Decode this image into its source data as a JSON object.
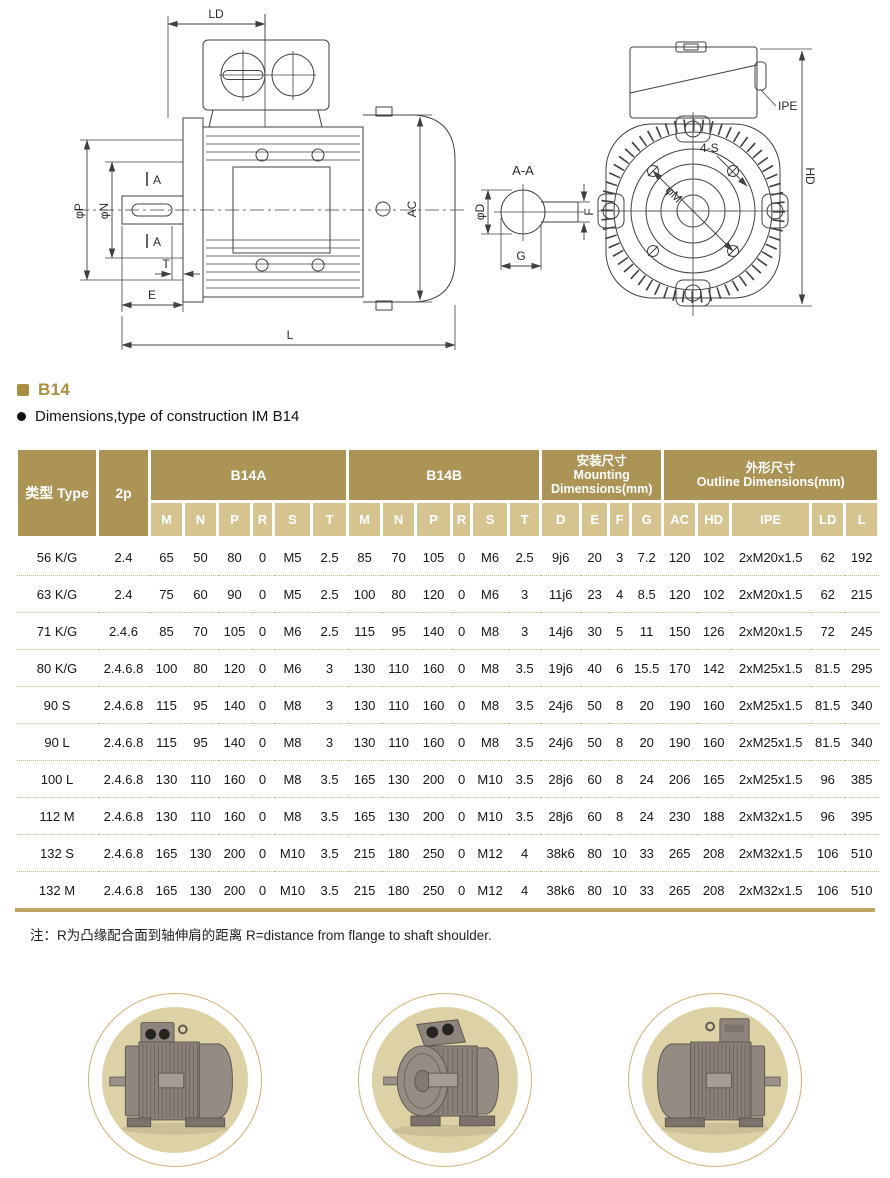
{
  "section": {
    "tag": "B14",
    "description": "Dimensions,type of construction IM B14"
  },
  "drawing_labels": {
    "side": {
      "ld": "LD",
      "phi_p": "φP",
      "phi_n": "φN",
      "a_upper": "A",
      "a_lower": "A",
      "t": "T",
      "e": "E",
      "l": "L",
      "ac": "AC"
    },
    "section_view": {
      "title": "A-A",
      "phi_d": "φD",
      "f": "F",
      "g": "G"
    },
    "front": {
      "ipe": "IPE",
      "four_s": "4-S",
      "phi_m": "φM",
      "hd": "HD"
    }
  },
  "table": {
    "header": {
      "type": "类型 Type",
      "p2": "2p",
      "b14a": "B14A",
      "b14b": "B14B",
      "mounting_zh": "安装尺寸",
      "mounting_en1": "Mounting",
      "mounting_en2": "Dimensions(mm)",
      "outline_zh": "外形尺寸",
      "outline_en": "Outline Dimensions(mm)"
    },
    "subheader": [
      "M",
      "N",
      "P",
      "R",
      "S",
      "T",
      "M",
      "N",
      "P",
      "R",
      "S",
      "T",
      "D",
      "E",
      "F",
      "G",
      "AC",
      "HD",
      "IPE",
      "LD",
      "L"
    ],
    "rows": [
      [
        "56 K/G",
        "2.4",
        "65",
        "50",
        "80",
        "0",
        "M5",
        "2.5",
        "85",
        "70",
        "105",
        "0",
        "M6",
        "2.5",
        "9j6",
        "20",
        "3",
        "7.2",
        "120",
        "102",
        "2xM20x1.5",
        "62",
        "192"
      ],
      [
        "63 K/G",
        "2.4",
        "75",
        "60",
        "90",
        "0",
        "M5",
        "2.5",
        "100",
        "80",
        "120",
        "0",
        "M6",
        "3",
        "11j6",
        "23",
        "4",
        "8.5",
        "120",
        "102",
        "2xM20x1.5",
        "62",
        "215"
      ],
      [
        "71 K/G",
        "2.4.6",
        "85",
        "70",
        "105",
        "0",
        "M6",
        "2.5",
        "115",
        "95",
        "140",
        "0",
        "M8",
        "3",
        "14j6",
        "30",
        "5",
        "11",
        "150",
        "126",
        "2xM20x1.5",
        "72",
        "245"
      ],
      [
        "80 K/G",
        "2.4.6.8",
        "100",
        "80",
        "120",
        "0",
        "M6",
        "3",
        "130",
        "110",
        "160",
        "0",
        "M8",
        "3.5",
        "19j6",
        "40",
        "6",
        "15.5",
        "170",
        "142",
        "2xM25x1.5",
        "81.5",
        "295"
      ],
      [
        "90 S",
        "2.4.6.8",
        "115",
        "95",
        "140",
        "0",
        "M8",
        "3",
        "130",
        "110",
        "160",
        "0",
        "M8",
        "3.5",
        "24j6",
        "50",
        "8",
        "20",
        "190",
        "160",
        "2xM25x1.5",
        "81.5",
        "340"
      ],
      [
        "90 L",
        "2.4.6.8",
        "115",
        "95",
        "140",
        "0",
        "M8",
        "3",
        "130",
        "110",
        "160",
        "0",
        "M8",
        "3.5",
        "24j6",
        "50",
        "8",
        "20",
        "190",
        "160",
        "2xM25x1.5",
        "81.5",
        "340"
      ],
      [
        "100 L",
        "2.4.6.8",
        "130",
        "110",
        "160",
        "0",
        "M8",
        "3.5",
        "165",
        "130",
        "200",
        "0",
        "M10",
        "3.5",
        "28j6",
        "60",
        "8",
        "24",
        "206",
        "165",
        "2xM25x1.5",
        "96",
        "385"
      ],
      [
        "112 M",
        "2.4.6.8",
        "130",
        "110",
        "160",
        "0",
        "M8",
        "3.5",
        "165",
        "130",
        "200",
        "0",
        "M10",
        "3.5",
        "28j6",
        "60",
        "8",
        "24",
        "230",
        "188",
        "2xM32x1.5",
        "96",
        "395"
      ],
      [
        "132 S",
        "2.4.6.8",
        "165",
        "130",
        "200",
        "0",
        "M10",
        "3.5",
        "215",
        "180",
        "250",
        "0",
        "M12",
        "4",
        "38k6",
        "80",
        "10",
        "33",
        "265",
        "208",
        "2xM32x1.5",
        "106",
        "510"
      ],
      [
        "132 M",
        "2.4.6.8",
        "165",
        "130",
        "200",
        "0",
        "M10",
        "3.5",
        "215",
        "180",
        "250",
        "0",
        "M12",
        "4",
        "38k6",
        "80",
        "10",
        "33",
        "265",
        "208",
        "2xM32x1.5",
        "106",
        "510"
      ]
    ]
  },
  "note": "注：R为凸缘配合面到轴伸肩的距离 R=distance from flange to shaft shoulder.",
  "colors": {
    "accent_gold": "#a98e42",
    "table_header_bg": "#ac9456",
    "table_subheader_bg": "#d5c490",
    "row_divider_dotted": "#ccbd8f",
    "table_bottom_border": "#c0a663",
    "medallion_bg": "#ddd2a6",
    "medallion_ring": "#c9b272",
    "drawing_line": "#404040"
  }
}
